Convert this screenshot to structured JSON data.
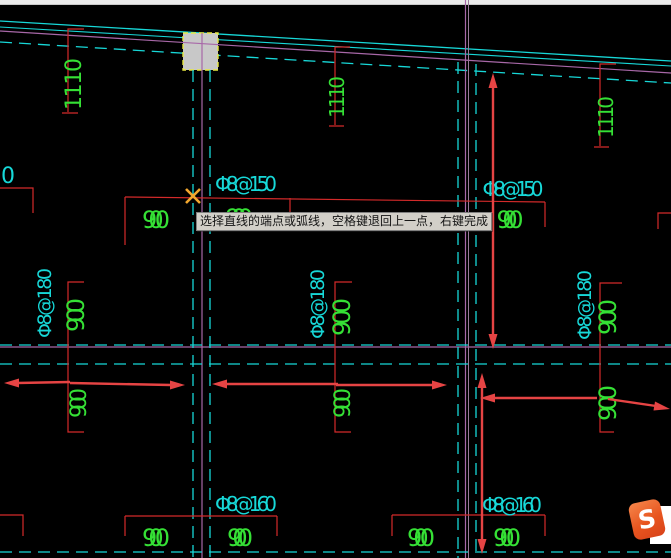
{
  "tooltip": {
    "text": "选择直线的端点或弧线，空格键退回上一点，右键完成"
  },
  "logo": {
    "letter": "S"
  },
  "labels": {
    "edge_cut": "0",
    "rebar": {
      "top_left": "Φ8@150",
      "top_right": "Φ8@150",
      "mid_left": "Φ8@180",
      "mid_center": "Φ8@180",
      "mid_right": "Φ8@180",
      "bottom_left": "Φ8@160",
      "bottom_right": "Φ8@160"
    },
    "dims": {
      "d1110_left": "1110",
      "d1110_mid": "1110",
      "d1110_right": "1110",
      "d900_top_left": "900",
      "d900_top_mid": "900",
      "d900_top_right": "900",
      "d900_mid_left": "900",
      "d900_mid_center": "900",
      "d900_mid_right": "900",
      "d900_low_left": "900",
      "d900_low_center": "900",
      "d900_low_right": "900",
      "d900_bot_1": "900",
      "d900_bot_2": "900",
      "d900_bot_3": "900",
      "d900_bot_4": "900"
    }
  },
  "colors": {
    "background": "#000000",
    "cyan": "#17d8d8",
    "green": "#35e035",
    "dim_red": "#d42a2a",
    "arrow_red": "#e64444",
    "magenta": "#a868a8",
    "cursor": "#f2a72e",
    "column_fill": "#c8c8c8",
    "column_highlight": "#e8e840",
    "tooltip_bg": "#d2cfc8",
    "logo_orange": "#e8551f"
  }
}
